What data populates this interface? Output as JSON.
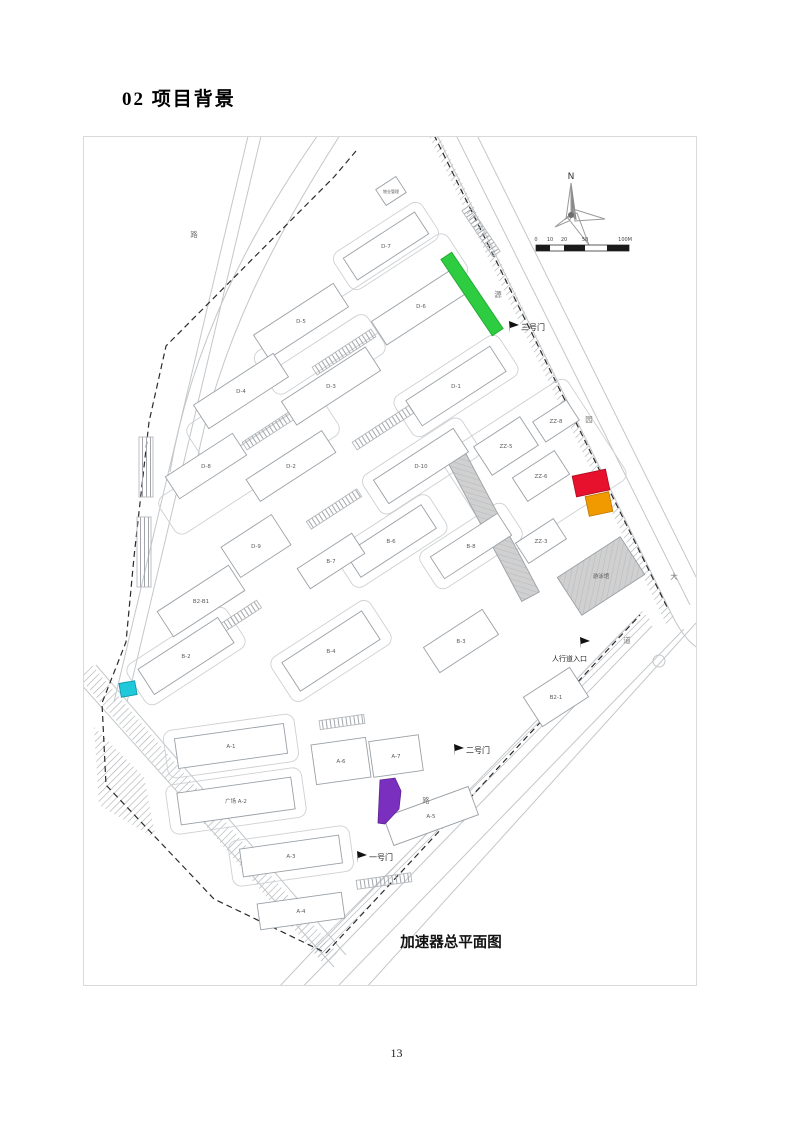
{
  "page": {
    "title": "02  项目背景",
    "page_number": "13"
  },
  "map": {
    "caption": "加速器总平面图",
    "compass_label": "N",
    "scale_labels": [
      "0",
      "10",
      "20",
      "50",
      "100M"
    ],
    "colors": {
      "green": "#2ecc40",
      "red": "#e8112d",
      "orange": "#f09a00",
      "purple": "#7b2fbe",
      "cyan": "#1fc8db",
      "building_fill": "#ffffff",
      "building_stroke": "#9aa0a6",
      "gray_fill": "#d0d0d0",
      "label_color": "#5b5b5b"
    },
    "gates": [
      {
        "label": "三号门",
        "x": 437,
        "y": 193,
        "fx": 426,
        "fy": 196,
        "fs": 8
      },
      {
        "label": "二号门",
        "x": 382,
        "y": 616,
        "fx": 371,
        "fy": 619,
        "fs": 8
      },
      {
        "label": "一号门",
        "x": 285,
        "y": 723,
        "fx": 274,
        "fy": 726,
        "fs": 8
      },
      {
        "label": "人行道入口",
        "x": 468,
        "y": 524,
        "fx": 497,
        "fy": 512,
        "fs": 7
      }
    ],
    "road_labels": [
      {
        "ch": "路",
        "x": 110,
        "y": 100
      },
      {
        "ch": "源",
        "x": 414,
        "y": 160
      },
      {
        "ch": "园",
        "x": 505,
        "y": 285
      },
      {
        "ch": "大",
        "x": 590,
        "y": 442
      },
      {
        "ch": "道",
        "x": 543,
        "y": 506
      },
      {
        "ch": "路",
        "x": 342,
        "y": 666
      }
    ],
    "buildings": [
      {
        "label": "D-7",
        "x": 302,
        "y": 109,
        "w": 85,
        "h": 26,
        "r": -33
      },
      {
        "label": "物业管理",
        "x": 307,
        "y": 54,
        "w": 24,
        "h": 19,
        "r": -33,
        "fs": 4
      },
      {
        "label": "D-5",
        "x": 217,
        "y": 184,
        "w": 95,
        "h": 28,
        "r": -33
      },
      {
        "label": "D-6",
        "x": 337,
        "y": 169,
        "w": 100,
        "h": 28,
        "r": -33
      },
      {
        "label": "D-4",
        "x": 157,
        "y": 254,
        "w": 95,
        "h": 28,
        "r": -33
      },
      {
        "label": "D-3",
        "x": 247,
        "y": 249,
        "w": 100,
        "h": 28,
        "r": -33
      },
      {
        "label": "D-1",
        "x": 372,
        "y": 249,
        "w": 100,
        "h": 30,
        "r": -33
      },
      {
        "label": "D-8",
        "x": 122,
        "y": 329,
        "w": 80,
        "h": 26,
        "r": -33
      },
      {
        "label": "D-2",
        "x": 207,
        "y": 329,
        "w": 90,
        "h": 26,
        "r": -33
      },
      {
        "label": "D-10",
        "x": 337,
        "y": 329,
        "w": 95,
        "h": 28,
        "r": -33
      },
      {
        "label": "ZZ-5",
        "x": 422,
        "y": 309,
        "w": 55,
        "h": 34,
        "r": -33
      },
      {
        "label": "ZZ-6",
        "x": 457,
        "y": 339,
        "w": 50,
        "h": 28,
        "r": -33
      },
      {
        "label": "ZZ-8",
        "x": 472,
        "y": 284,
        "w": 40,
        "h": 24,
        "r": -33
      },
      {
        "label": "B-6",
        "x": 307,
        "y": 404,
        "w": 90,
        "h": 28,
        "r": -33
      },
      {
        "label": "B-7",
        "x": 247,
        "y": 424,
        "w": 65,
        "h": 24,
        "r": -33
      },
      {
        "label": "B-8",
        "x": 387,
        "y": 409,
        "w": 80,
        "h": 26,
        "r": -33
      },
      {
        "label": "ZZ-3",
        "x": 457,
        "y": 404,
        "w": 45,
        "h": 24,
        "r": -33
      },
      {
        "label": "D-9",
        "x": 172,
        "y": 409,
        "w": 60,
        "h": 36,
        "r": -33
      },
      {
        "label": "B2-B1",
        "x": 117,
        "y": 464,
        "w": 85,
        "h": 30,
        "r": -33
      },
      {
        "label": "B-2",
        "x": 102,
        "y": 519,
        "w": 95,
        "h": 30,
        "r": -33
      },
      {
        "label": "B-4",
        "x": 247,
        "y": 514,
        "w": 95,
        "h": 34,
        "r": -33
      },
      {
        "label": "B-3",
        "x": 377,
        "y": 504,
        "w": 70,
        "h": 30,
        "r": -33
      },
      {
        "label": "B2-1",
        "x": 472,
        "y": 560,
        "w": 55,
        "h": 35,
        "r": -33
      },
      {
        "label": "A-1",
        "x": 147,
        "y": 609,
        "w": 110,
        "h": 30,
        "r": -8
      },
      {
        "label": "广场 A-2",
        "x": 152,
        "y": 664,
        "w": 115,
        "h": 32,
        "r": -8
      },
      {
        "label": "A-3",
        "x": 207,
        "y": 719,
        "w": 100,
        "h": 28,
        "r": -8
      },
      {
        "label": "A-6",
        "x": 257,
        "y": 624,
        "w": 55,
        "h": 40,
        "r": -8
      },
      {
        "label": "A-7",
        "x": 312,
        "y": 619,
        "w": 50,
        "h": 36,
        "r": -8
      },
      {
        "label": "A-5",
        "x": 347,
        "y": 679,
        "w": 90,
        "h": 30,
        "r": -20
      },
      {
        "label": "A-4",
        "x": 217,
        "y": 774,
        "w": 85,
        "h": 26,
        "r": -8
      }
    ],
    "gray_buildings": [
      {
        "label": "游泳馆",
        "x": 517,
        "y": 439,
        "w": 75,
        "h": 45,
        "r": -33
      },
      {
        "label": "",
        "x": 409,
        "y": 389,
        "w": 160,
        "h": 20,
        "r": 62
      }
    ],
    "outlines": [
      {
        "x": 302,
        "y": 109,
        "w": 105,
        "h": 44,
        "r": -33
      },
      {
        "x": 277,
        "y": 177,
        "w": 230,
        "h": 50,
        "r": -33
      },
      {
        "x": 202,
        "y": 252,
        "w": 215,
        "h": 46,
        "r": -33
      },
      {
        "x": 372,
        "y": 249,
        "w": 125,
        "h": 48,
        "r": -33
      },
      {
        "x": 165,
        "y": 329,
        "w": 195,
        "h": 44,
        "r": -33
      },
      {
        "x": 337,
        "y": 329,
        "w": 118,
        "h": 46,
        "r": -33
      },
      {
        "x": 307,
        "y": 404,
        "w": 112,
        "h": 46,
        "r": -33
      },
      {
        "x": 387,
        "y": 409,
        "w": 102,
        "h": 44,
        "r": -33
      },
      {
        "x": 247,
        "y": 514,
        "w": 118,
        "h": 52,
        "r": -33
      },
      {
        "x": 102,
        "y": 519,
        "w": 118,
        "h": 48,
        "r": -33
      },
      {
        "x": 450,
        "y": 330,
        "w": 150,
        "h": 120,
        "r": -33
      },
      {
        "x": 147,
        "y": 609,
        "w": 132,
        "h": 48,
        "r": -8
      },
      {
        "x": 152,
        "y": 664,
        "w": 137,
        "h": 50,
        "r": -8
      },
      {
        "x": 207,
        "y": 719,
        "w": 122,
        "h": 46,
        "r": -8
      }
    ],
    "parking": [
      {
        "x": 260,
        "y": 215,
        "w": 70,
        "h": 9,
        "r": -33
      },
      {
        "x": 190,
        "y": 290,
        "w": 70,
        "h": 9,
        "r": -33
      },
      {
        "x": 300,
        "y": 290,
        "w": 70,
        "h": 9,
        "r": -33
      },
      {
        "x": 250,
        "y": 372,
        "w": 60,
        "h": 9,
        "r": -33
      },
      {
        "x": 152,
        "y": 482,
        "w": 55,
        "h": 9,
        "r": -33
      },
      {
        "x": 397,
        "y": 94,
        "w": 55,
        "h": 9,
        "r": 56
      },
      {
        "x": 62,
        "y": 330,
        "w": 14,
        "h": 60,
        "r": 0
      },
      {
        "x": 60,
        "y": 415,
        "w": 14,
        "h": 70,
        "r": 0
      },
      {
        "x": 300,
        "y": 744,
        "w": 55,
        "h": 9,
        "r": -8
      },
      {
        "x": 258,
        "y": 585,
        "w": 45,
        "h": 9,
        "r": -8
      }
    ],
    "highlights": {
      "green_strip": {
        "x": 388,
        "y": 157,
        "w": 92,
        "h": 13,
        "r": 56
      },
      "red": {
        "x": 507,
        "y": 346,
        "w": 34,
        "h": 21,
        "r": -12
      },
      "orange": {
        "x": 515,
        "y": 367,
        "w": 24,
        "h": 20,
        "r": -12
      },
      "purple_points": "296,643 311,641 317,654 315,672 301,687 294,686",
      "cyan": {
        "x": 44,
        "y": 552,
        "w": 16,
        "h": 14,
        "r": -10
      }
    }
  }
}
